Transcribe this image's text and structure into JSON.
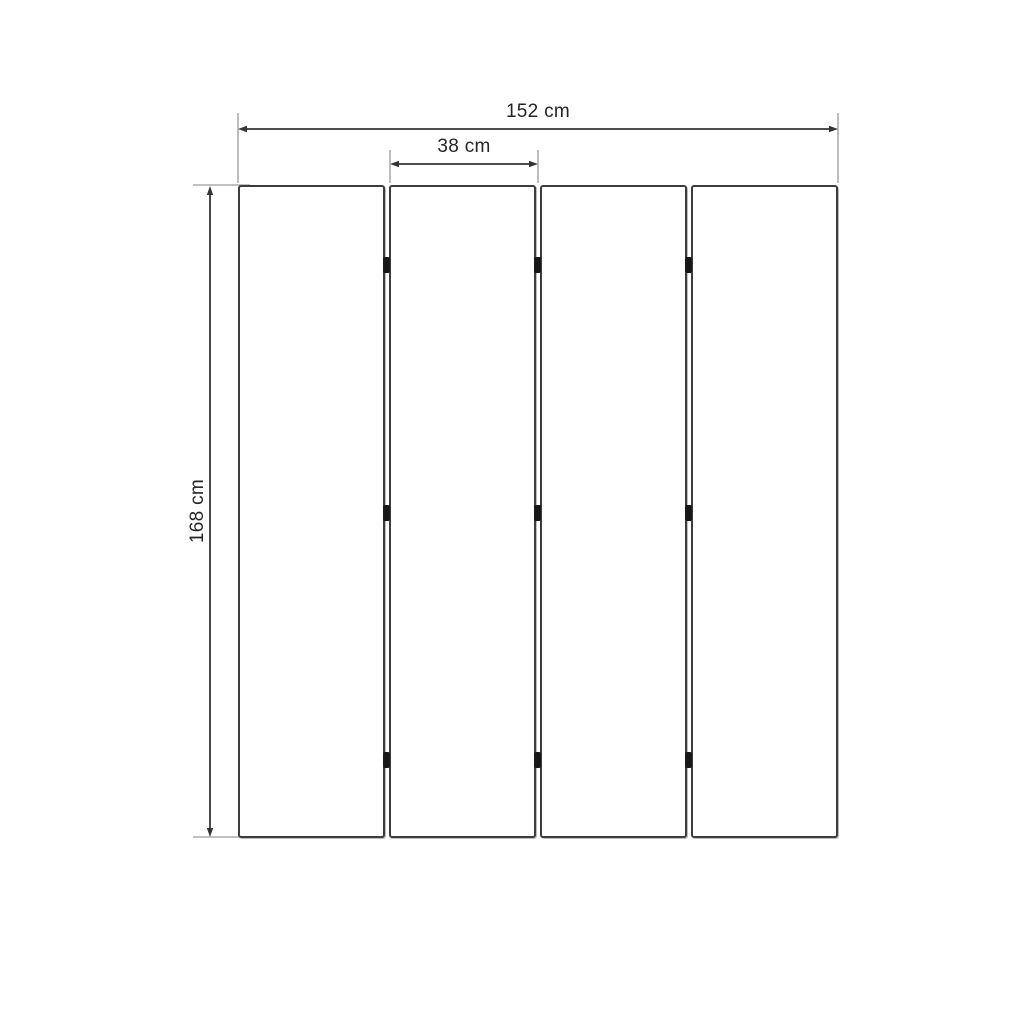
{
  "diagram": {
    "labels": {
      "total_width": "152 cm",
      "panel_width": "38 cm",
      "height": "168 cm"
    },
    "measurements": {
      "total_width_cm": 152,
      "panel_width_cm": 38,
      "height_cm": 168,
      "panel_count": 4,
      "joint_count": 3,
      "hinges_per_joint": 3
    },
    "colors": {
      "background": "#ffffff",
      "panel_fill": "#ffffff",
      "panel_border": "#3d3d3d",
      "dimension_line": "#353535",
      "extension_line": "#9c9c9c",
      "hinge": "#181818",
      "label_text": "#252525"
    }
  }
}
